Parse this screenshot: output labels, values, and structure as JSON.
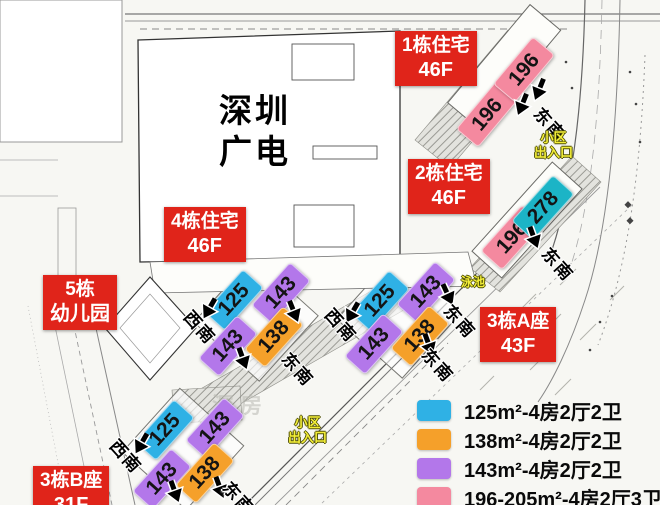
{
  "campus": {
    "line1": "深圳",
    "line2": "广电"
  },
  "buildings": [
    {
      "line1": "1栋住宅",
      "line2": "46F"
    },
    {
      "line1": "2栋住宅",
      "line2": "46F"
    },
    {
      "line1": "4栋住宅",
      "line2": "46F"
    },
    {
      "line1": "5栋",
      "line2": "幼儿园"
    },
    {
      "line1": "3栋A座",
      "line2": "43F"
    },
    {
      "line1": "3栋B座",
      "line2": "31F"
    }
  ],
  "units": [
    {
      "value": "196",
      "type": "pink"
    },
    {
      "value": "196",
      "type": "pink"
    },
    {
      "value": "196",
      "type": "pink"
    },
    {
      "value": "278",
      "type": "teal"
    },
    {
      "value": "125",
      "type": "cyan"
    },
    {
      "value": "143",
      "type": "purple"
    },
    {
      "value": "143",
      "type": "purple"
    },
    {
      "value": "138",
      "type": "orange"
    },
    {
      "value": "125",
      "type": "cyan"
    },
    {
      "value": "143",
      "type": "purple"
    },
    {
      "value": "143",
      "type": "purple"
    },
    {
      "value": "138",
      "type": "orange"
    },
    {
      "value": "125",
      "type": "cyan"
    },
    {
      "value": "143",
      "type": "purple"
    },
    {
      "value": "143",
      "type": "purple"
    },
    {
      "value": "138",
      "type": "orange"
    }
  ],
  "directions": [
    {
      "text": "东南"
    },
    {
      "text": "东南"
    },
    {
      "text": "西南"
    },
    {
      "text": "东南"
    },
    {
      "text": "西南"
    },
    {
      "text": "东南"
    },
    {
      "text": "东南"
    },
    {
      "text": "西南"
    },
    {
      "text": "东南"
    }
  ],
  "map_texts": {
    "entrance1": [
      "小区",
      "出入口"
    ],
    "entrance2": [
      "小区",
      "出入口"
    ],
    "pool": "泳池",
    "watermark": "深房"
  },
  "legend": {
    "items": [
      {
        "color": "#2fb1e5",
        "label": "125m²-4房2厅2卫"
      },
      {
        "color": "#f5a02a",
        "label": "138m²-4房2厅2卫"
      },
      {
        "color": "#b377ea",
        "label": "143m²-4房2厅2卫"
      },
      {
        "color": "#f4899f",
        "label": "196-205m²-4房2厅3卫"
      }
    ]
  },
  "colors": {
    "unit_125": "#2fb1e5",
    "unit_138": "#f5a02a",
    "unit_143": "#b377ea",
    "unit_196": "#f4899f",
    "unit_278": "#1cb4c6",
    "building_label": "#e0241a",
    "map_yellow_text": "#f3ee39"
  }
}
